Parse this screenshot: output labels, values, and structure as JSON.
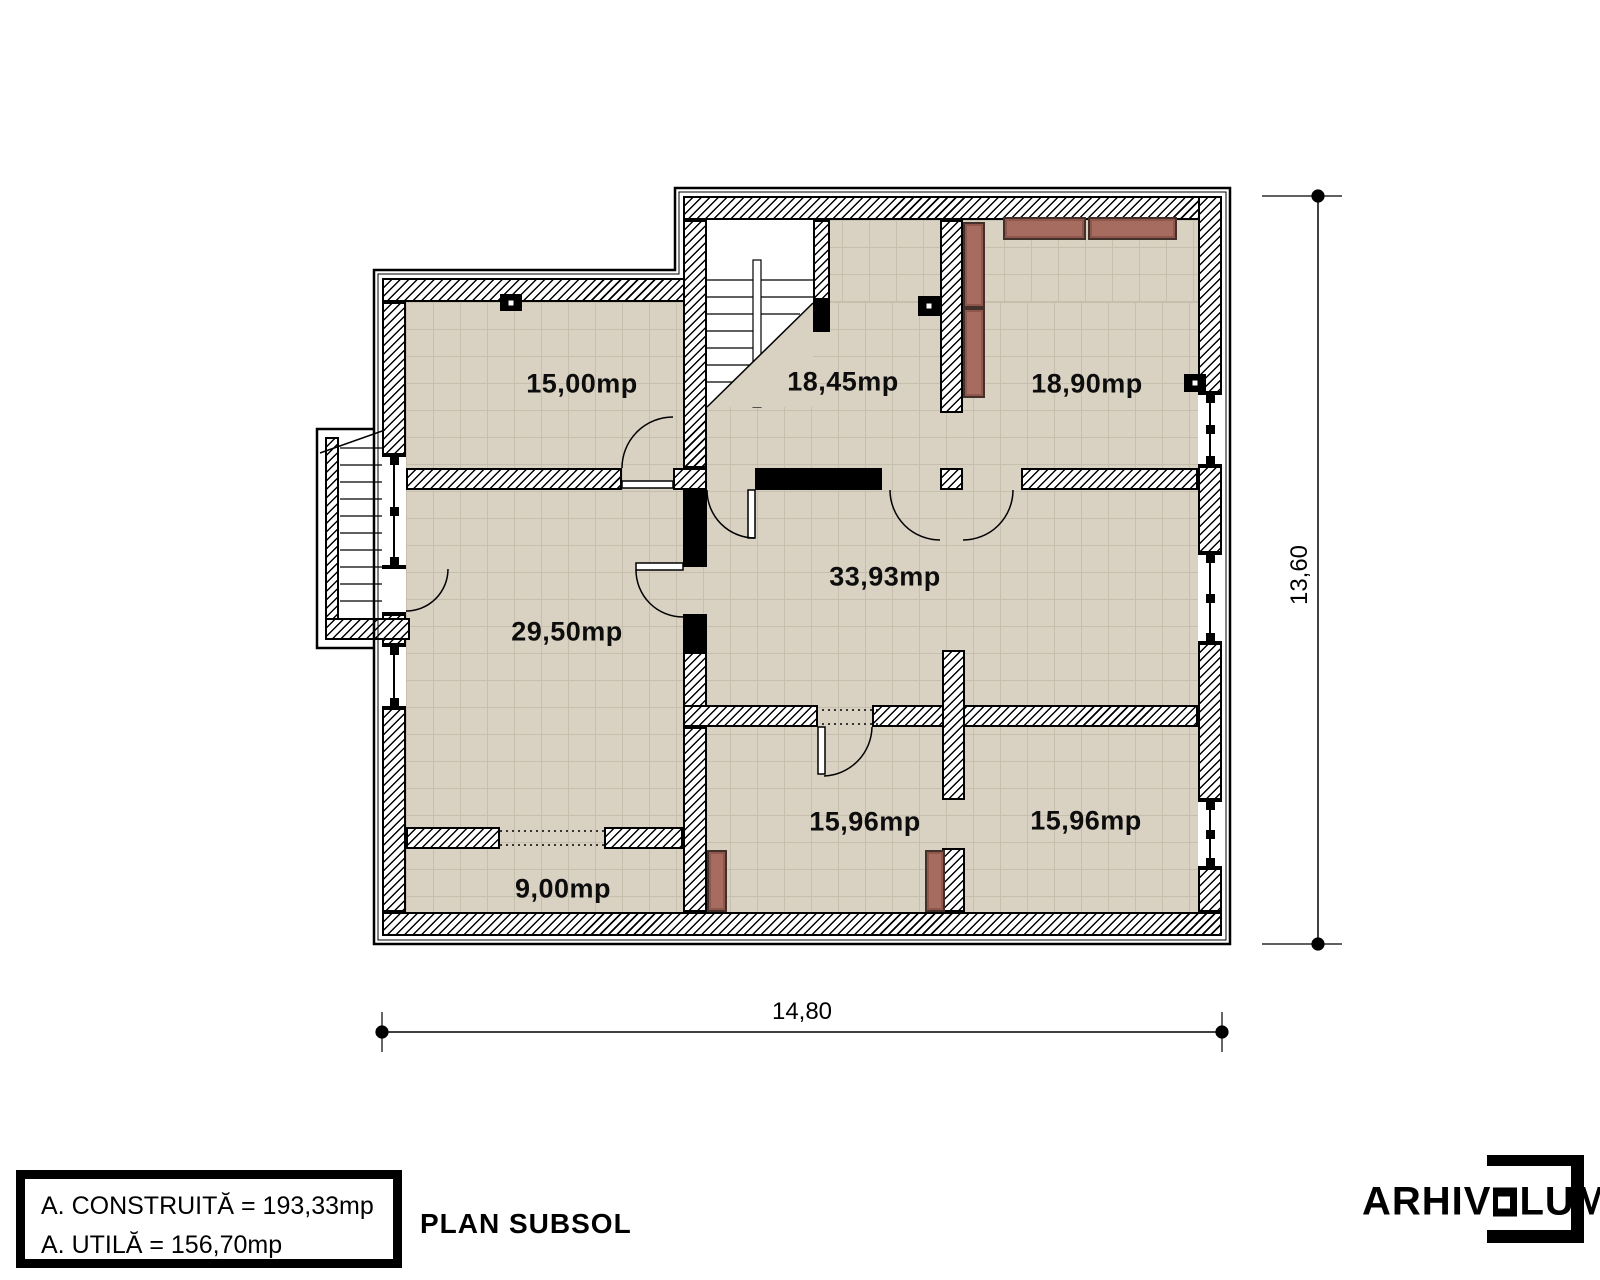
{
  "drawing": {
    "plan_title": "PLAN SUBSOL",
    "legend": {
      "built_area": "A. CONSTRUITĂ = 193,33mp",
      "usable_area": "A. UTILĂ = 156,70mp"
    },
    "rooms": [
      {
        "id": "room-top-left",
        "area": "15,00mp"
      },
      {
        "id": "room-top-center",
        "area": "18,45mp"
      },
      {
        "id": "room-top-right",
        "area": "18,90mp"
      },
      {
        "id": "room-mid-left",
        "area": "29,50mp"
      },
      {
        "id": "room-hall",
        "area": "33,93mp"
      },
      {
        "id": "room-bottom-left",
        "area": "9,00mp"
      },
      {
        "id": "room-bottom-center",
        "area": "15,96mp"
      },
      {
        "id": "room-bottom-right",
        "area": "15,96mp"
      }
    ],
    "dimensions": {
      "overall_width": "14,80",
      "overall_height": "13,60"
    },
    "colors": {
      "floor": "#d9d2c3",
      "floor_grid": "#c6bfae",
      "furniture": "#a76c60",
      "linework": "#000000"
    }
  },
  "branding": {
    "logo_prefix": "ARHIV",
    "logo_suffix": "LUM"
  }
}
